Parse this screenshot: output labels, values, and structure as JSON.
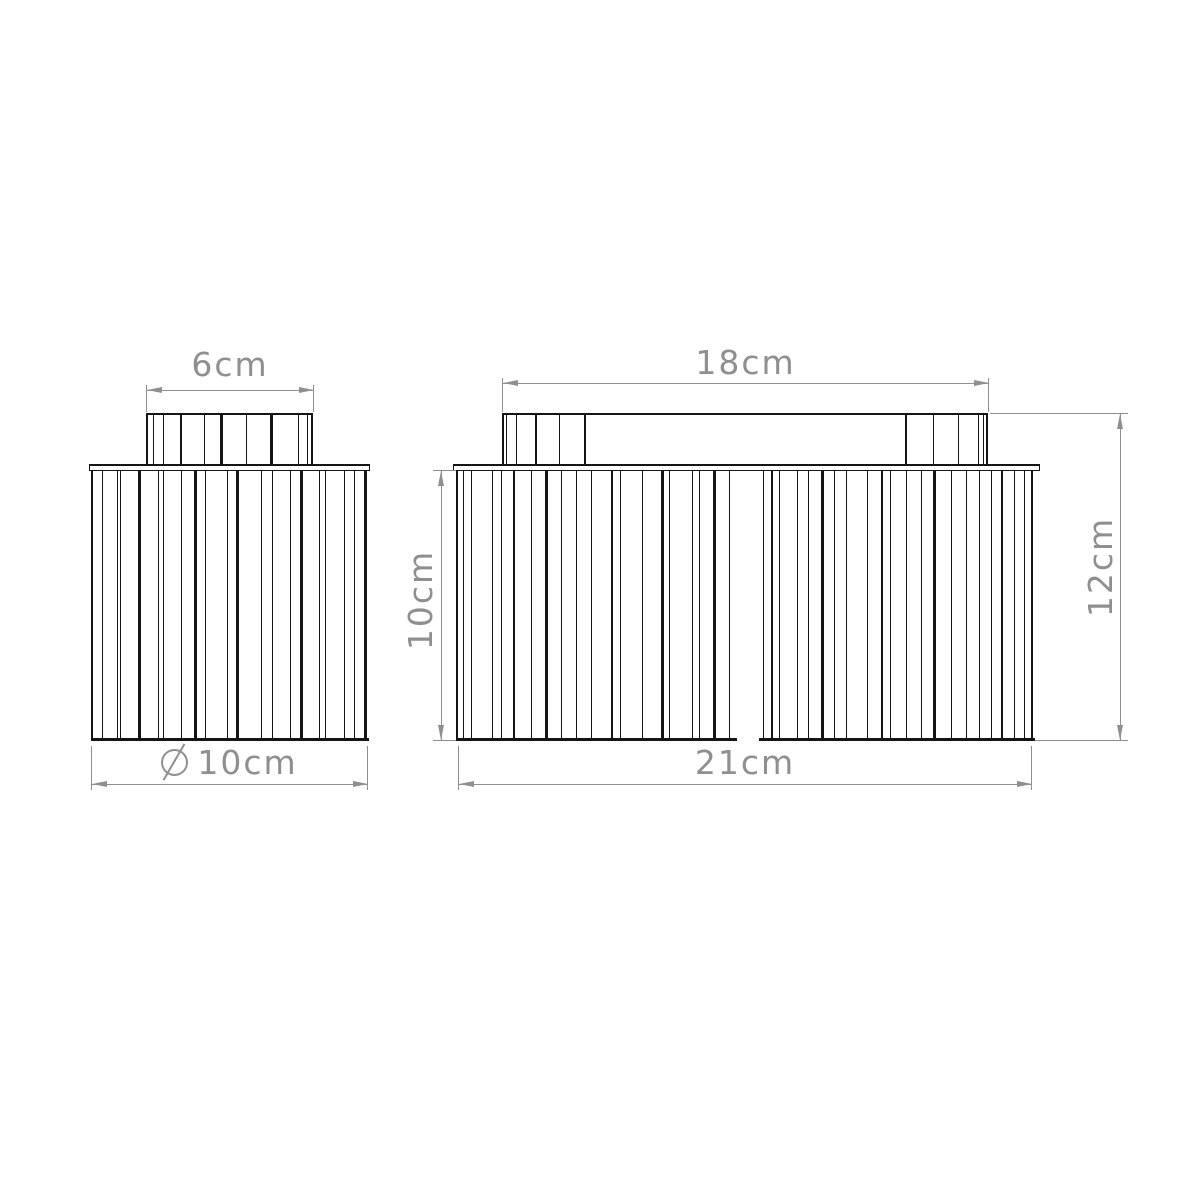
{
  "canvas": {
    "background": "#ffffff",
    "line_color": "#151515",
    "dim_color": "#8f8f8f"
  },
  "dims": {
    "cap_width_left": {
      "label": "6cm"
    },
    "top_width_right": {
      "label": "18cm"
    },
    "diameter_left": {
      "symbol": "⌀",
      "label": "10cm"
    },
    "body_width_right": {
      "label": "21cm"
    },
    "body_height_right": {
      "label": "10cm"
    },
    "total_height_right": {
      "label": "12cm"
    }
  },
  "figure": {
    "description": "Front-view line drawing of two ribbed cylindrical ceiling lamps",
    "sections": [
      {
        "name": "left-lamp-cap",
        "x": 146,
        "y": 413,
        "w": 167,
        "h": 51,
        "b": {
          "t": 2,
          "l": 2,
          "r": 2
        },
        "ribs": [
          [
            0.03,
            1
          ],
          [
            0.09,
            1
          ],
          [
            0.2,
            2
          ],
          [
            0.34,
            1
          ],
          [
            0.44,
            3
          ],
          [
            0.59,
            1
          ],
          [
            0.74,
            3
          ],
          [
            0.9,
            1
          ],
          [
            0.955,
            1
          ]
        ]
      },
      {
        "name": "right-lamp-top-bar",
        "x": 502,
        "y": 413,
        "w": 486,
        "h": 51,
        "b": {
          "t": 2,
          "l": 2,
          "r": 2
        }
      },
      {
        "name": "right-lamp-cap-left",
        "x": 502,
        "y": 413,
        "w": 83,
        "h": 51,
        "ribs": [
          [
            0.05,
            1
          ],
          [
            0.17,
            1
          ],
          [
            0.41,
            2
          ],
          [
            0.69,
            1
          ],
          [
            1.0,
            2
          ]
        ]
      },
      {
        "name": "right-lamp-cap-right",
        "x": 905,
        "y": 413,
        "w": 83,
        "h": 51,
        "ribs": [
          [
            0.0,
            2
          ],
          [
            0.34,
            1
          ],
          [
            0.64,
            1
          ],
          [
            0.88,
            1
          ],
          [
            0.95,
            1
          ]
        ]
      },
      {
        "name": "left-lamp-body",
        "x": 91,
        "y": 471,
        "w": 276,
        "h": 270,
        "b": {
          "l": 2,
          "r": 2
        },
        "bottom": [
          [
            0,
            1
          ]
        ],
        "ribs": [
          [
            0.033,
            1
          ],
          [
            0.087,
            1
          ],
          [
            0.101,
            1
          ],
          [
            0.167,
            3
          ],
          [
            0.239,
            1
          ],
          [
            0.257,
            1
          ],
          [
            0.322,
            1
          ],
          [
            0.37,
            3
          ],
          [
            0.406,
            1
          ],
          [
            0.486,
            1
          ],
          [
            0.522,
            3
          ],
          [
            0.612,
            1
          ],
          [
            0.649,
            1
          ],
          [
            0.714,
            1
          ],
          [
            0.757,
            3
          ],
          [
            0.822,
            1
          ],
          [
            0.841,
            1
          ],
          [
            0.913,
            1
          ],
          [
            0.949,
            1
          ],
          [
            0.982,
            1
          ]
        ]
      },
      {
        "name": "right-lamp-body",
        "x": 456,
        "y": 471,
        "w": 577,
        "h": 270,
        "b": {
          "l": 2,
          "r": 2
        },
        "bottom": [
          [
            0,
            0.4835
          ],
          [
            0.5217,
            1
          ]
        ],
        "ribs": [
          [
            0.01,
            1
          ],
          [
            0.024,
            1
          ],
          [
            0.059,
            1
          ],
          [
            0.076,
            1
          ],
          [
            0.097,
            2
          ],
          [
            0.128,
            1
          ],
          [
            0.154,
            3
          ],
          [
            0.18,
            1
          ],
          [
            0.206,
            1
          ],
          [
            0.232,
            1
          ],
          [
            0.267,
            2
          ],
          [
            0.281,
            1
          ],
          [
            0.319,
            1
          ],
          [
            0.354,
            3
          ],
          [
            0.367,
            1
          ],
          [
            0.406,
            1
          ],
          [
            0.418,
            1
          ],
          [
            0.444,
            3
          ],
          [
            0.47,
            1
          ],
          [
            0.53,
            1
          ],
          [
            0.544,
            2
          ],
          [
            0.558,
            1
          ],
          [
            0.588,
            1
          ],
          [
            0.607,
            1
          ],
          [
            0.631,
            3
          ],
          [
            0.653,
            1
          ],
          [
            0.674,
            1
          ],
          [
            0.709,
            1
          ],
          [
            0.735,
            2
          ],
          [
            0.749,
            1
          ],
          [
            0.778,
            1
          ],
          [
            0.804,
            1
          ],
          [
            0.825,
            3
          ],
          [
            0.856,
            1
          ],
          [
            0.882,
            1
          ],
          [
            0.903,
            1
          ],
          [
            0.925,
            1
          ],
          [
            0.943,
            2
          ],
          [
            0.964,
            1
          ],
          [
            0.981,
            1
          ]
        ]
      },
      {
        "name": "left-lamp-flange",
        "x": 89,
        "y": 464,
        "w": 281,
        "h": 7,
        "fill": true,
        "b": {
          "t": 2,
          "l": 1,
          "r": 1,
          "btm": 1
        }
      },
      {
        "name": "right-lamp-flange",
        "x": 453,
        "y": 464,
        "w": 587,
        "h": 7,
        "fill": true,
        "b": {
          "t": 2,
          "l": 1,
          "r": 1,
          "btm": 1
        }
      }
    ]
  }
}
